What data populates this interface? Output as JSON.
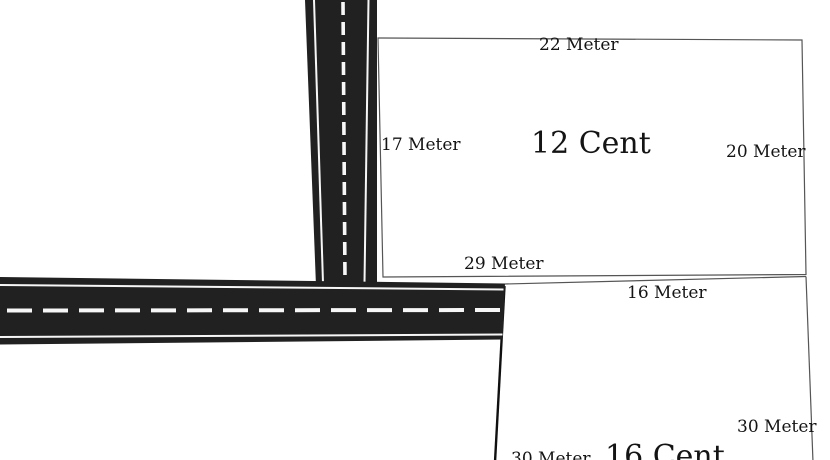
{
  "colors": {
    "background": "#ffffff",
    "road": "#212121",
    "road_line": "#f7f7f7",
    "boundary": "#555555",
    "boundary_dark": "#101010",
    "text": "#141414"
  },
  "plots": [
    {
      "title": "12 Cent",
      "labels": {
        "top": "22 Meter",
        "left": "17 Meter",
        "right": "20 Meter",
        "bottom": "29 Meter"
      }
    },
    {
      "title": "16 Cent",
      "labels": {
        "top": "16 Meter",
        "right": "30 Meter",
        "bottom": "30 Meter"
      }
    }
  ]
}
